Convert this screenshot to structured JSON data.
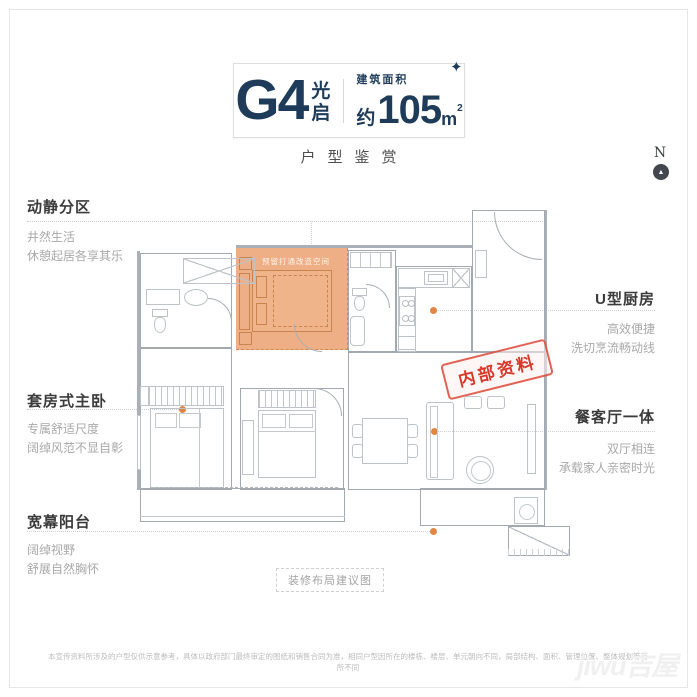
{
  "title": {
    "code": "G4",
    "name": "光启",
    "area_label": "建筑面积",
    "area_approx": "约",
    "area_value": "105",
    "area_unit": "m",
    "area_sup": "2",
    "subtitle": "户型鉴赏",
    "sparkle": "✦"
  },
  "compass": {
    "letter": "N",
    "arrow": "▲"
  },
  "features_left": [
    {
      "title": "动静分区",
      "lines": [
        "井然生活",
        "休憩起居各享其乐"
      ]
    },
    {
      "title": "套房式主卧",
      "lines": [
        "专属舒适尺度",
        "阔绰风范不显自彰"
      ]
    },
    {
      "title": "宽幕阳台",
      "lines": [
        "阔绰视野",
        "舒展自然胸怀"
      ]
    }
  ],
  "features_right": [
    {
      "title": "U型厨房",
      "lines": [
        "高效便捷",
        "洗切烹流畅动线"
      ]
    },
    {
      "title": "餐客厅一体",
      "lines": [
        "双厅相连",
        "承载家人亲密时光"
      ]
    }
  ],
  "plan": {
    "highlight_note": "预留打通改造空间",
    "caption": "装修布局建议图",
    "stamp": "内部资料"
  },
  "footer": {
    "disclaimer": "本宣传资料所涉及的户型仅供示意参考，具体以政府部门最终审定的图纸和销售合同为准，相同户型因所在的楼栋、楼层、单元朝向不同，局部结构、面积、管理位置、整体规划等有所不同",
    "watermark": "jiwu吉屋"
  },
  "colors": {
    "navy": "#1e3c5a",
    "orange_dot": "#e08645",
    "highlight_fill": "#e99964",
    "stamp_red": "#d8382a",
    "wall_gray": "#a2a9b0"
  }
}
